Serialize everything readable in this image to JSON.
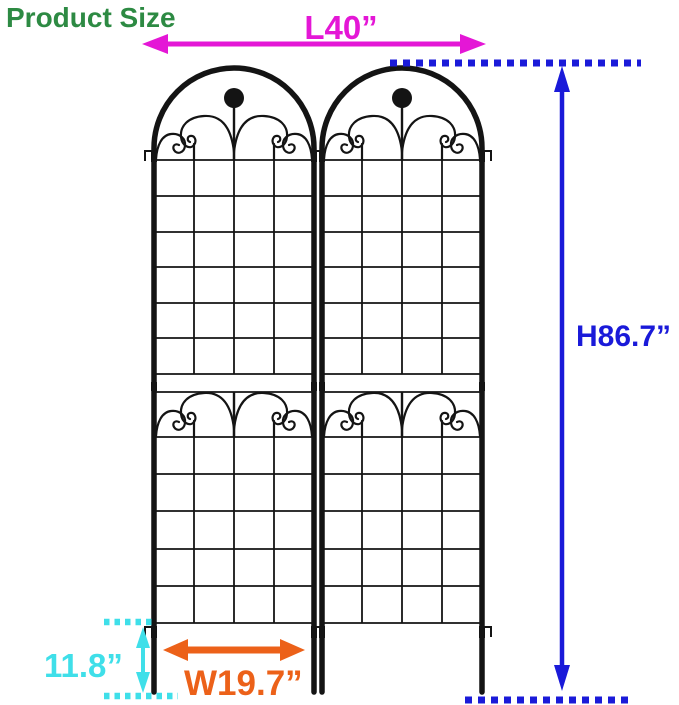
{
  "title": "Product Size",
  "colors": {
    "title": "#2d8a43",
    "length": "#e417d6",
    "height": "#1a1ad9",
    "width": "#ec6119",
    "stake": "#3fdfe9",
    "trellis": "#141414"
  },
  "dimensions": {
    "length": "L40”",
    "height": "H86.7”",
    "width": "W19.7”",
    "stake_depth": "11.8”"
  },
  "product": {
    "type": "garden trellis panels",
    "panel_count": "2"
  }
}
